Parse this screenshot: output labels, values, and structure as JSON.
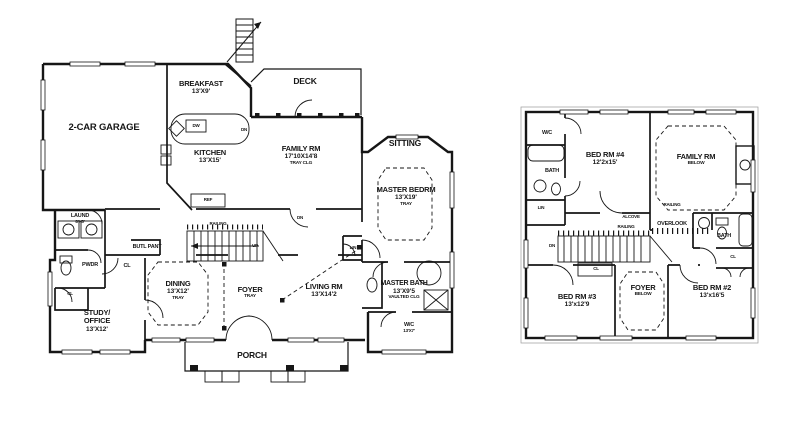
{
  "colors": {
    "ink": "#161616",
    "paper": "#ffffff"
  },
  "first_floor": {
    "garage": {
      "name": "2-CAR GARAGE"
    },
    "breakfast": {
      "name": "BREAKFAST",
      "dims": "13'X9'"
    },
    "kitchen": {
      "name": "KITCHEN",
      "dims": "13'X15'"
    },
    "deck": {
      "name": "DECK"
    },
    "family": {
      "name": "FAMILY RM",
      "dims": "17'10X14'8",
      "note": "TRAY CLG"
    },
    "sitting": {
      "name": "SITTING"
    },
    "master_bed": {
      "name": "MASTER BEDRM",
      "dims": "13'X19'",
      "note": "TRAY"
    },
    "dining": {
      "name": "DINING",
      "dims": "13'X12'",
      "note": "TRAY"
    },
    "foyer": {
      "name": "FOYER",
      "note": "TRAY"
    },
    "living": {
      "name": "LIVING RM",
      "dims": "13'X14'2"
    },
    "study": {
      "name1": "STUDY/",
      "name2": "OFFICE",
      "dims": "13'X12'"
    },
    "porch": {
      "name": "PORCH"
    },
    "master_bath": {
      "name": "MASTER BATH",
      "dims": "13'X9'5",
      "note": "VAULTED CLG"
    },
    "wc": {
      "name": "W/C",
      "dims": "13'X7'"
    },
    "laund": {
      "name": "LAUND",
      "dims": "8'X5'"
    },
    "pwdr": "PWDR",
    "butler": "BUTL PANT"
  },
  "second_floor": {
    "bed4": {
      "name": "BED RM #4",
      "dims": "12'2x15'"
    },
    "family_below": {
      "name": "FAMILY RM",
      "note": "BELOW"
    },
    "bed3": {
      "name": "BED RM #3",
      "dims": "13'x12'9"
    },
    "foyer_below": {
      "name": "FOYER",
      "note": "BELOW"
    },
    "bed2": {
      "name": "BED RM #2",
      "dims": "13'x16'5"
    },
    "overlook": "OVERLOOK",
    "alcove": "ALCOVE"
  },
  "misc": {
    "cl": "CL",
    "dn": "DN",
    "up": "UP",
    "lin": "LIN",
    "railing": "RAILING",
    "dw": "DW",
    "ref": "REF",
    "wc": "W/C",
    "bath": "BATH"
  }
}
